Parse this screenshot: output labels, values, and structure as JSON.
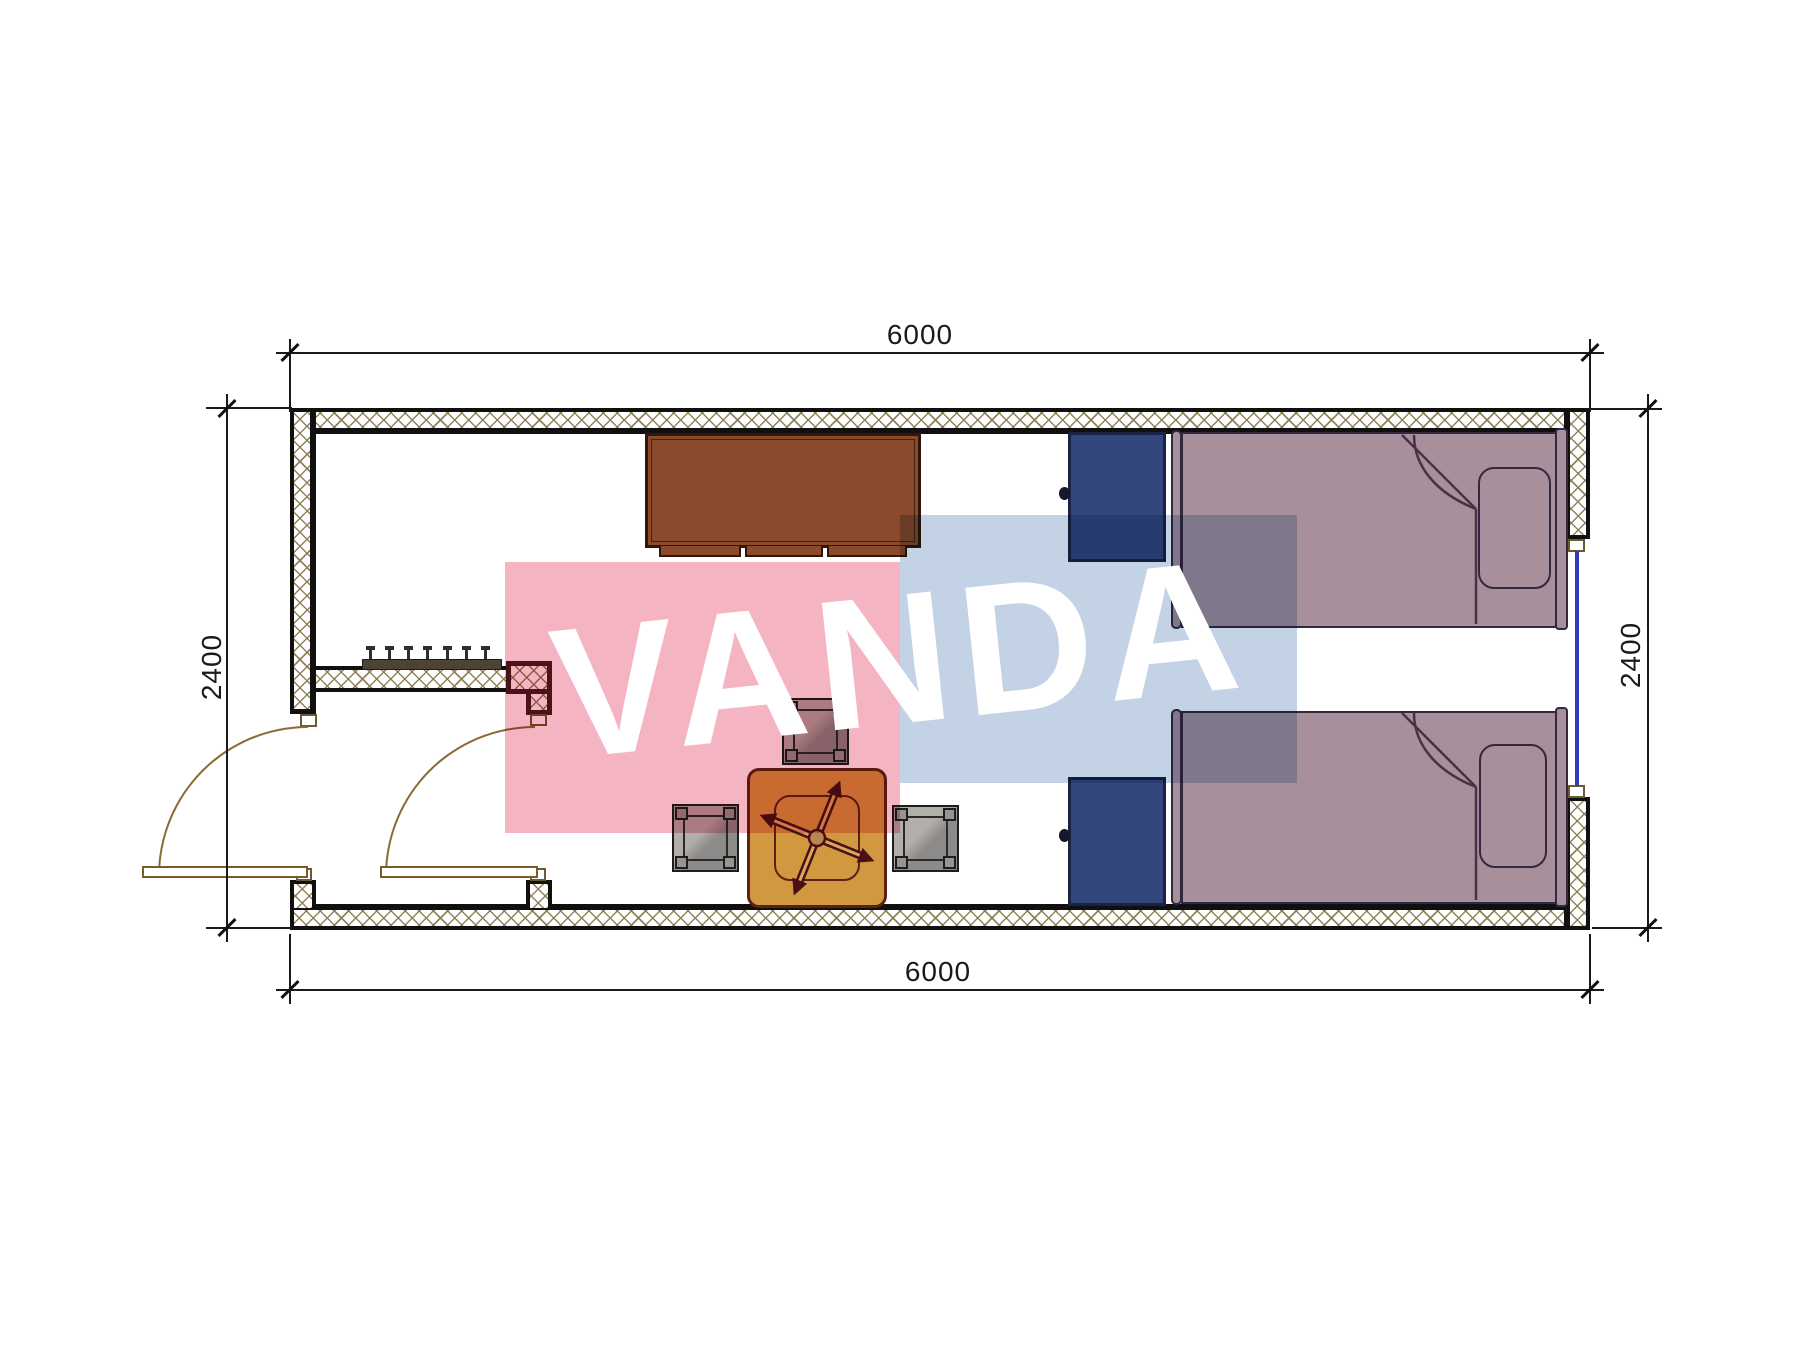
{
  "dimensions": {
    "top": "6000",
    "bottom": "6000",
    "left": "2400",
    "right": "2400"
  },
  "watermark": {
    "text": "VANDA",
    "pink_block_color": "#f5b4c1",
    "blue_block_color": "#c3d2e4",
    "text_color": "#ffffff"
  },
  "palette": {
    "wall_hatch": "#8d7c52",
    "wall_line": "#101010",
    "highlighted_wall": "#4d1b20",
    "cabinet": "#8b4a2b",
    "nightstand": "#33477d",
    "bed": "#a7909b",
    "table": "#d1983f",
    "stool": "#9c9893",
    "window_glass": "#2b3cc0",
    "door": "#8a6a35"
  },
  "elements": [
    {
      "name": "exterior-walls"
    },
    {
      "name": "vestibule-partition-wall"
    },
    {
      "name": "entry-door"
    },
    {
      "name": "interior-door"
    },
    {
      "name": "window-right-wall"
    },
    {
      "name": "coat-rack"
    },
    {
      "name": "sideboard-cabinet"
    },
    {
      "name": "nightstand-top"
    },
    {
      "name": "nightstand-bottom"
    },
    {
      "name": "single-bed-top"
    },
    {
      "name": "single-bed-bottom"
    },
    {
      "name": "square-table-with-fan"
    },
    {
      "name": "stool-top"
    },
    {
      "name": "stool-left"
    },
    {
      "name": "stool-right"
    }
  ]
}
